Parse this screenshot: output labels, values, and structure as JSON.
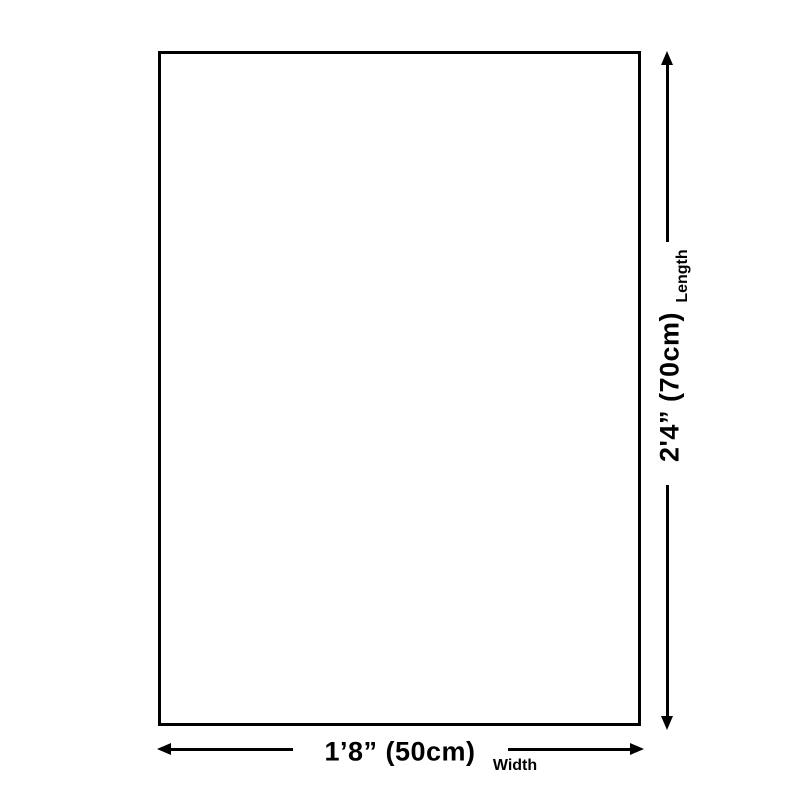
{
  "colors": {
    "background": "#ffffff",
    "line": "#000000",
    "text": "#000000"
  },
  "diagram": {
    "type": "product-dimension-diagram",
    "length": {
      "value": "2'4” (70cm)",
      "label": "Length"
    },
    "width": {
      "value": "1’8” (50cm)",
      "label": "Width"
    }
  }
}
